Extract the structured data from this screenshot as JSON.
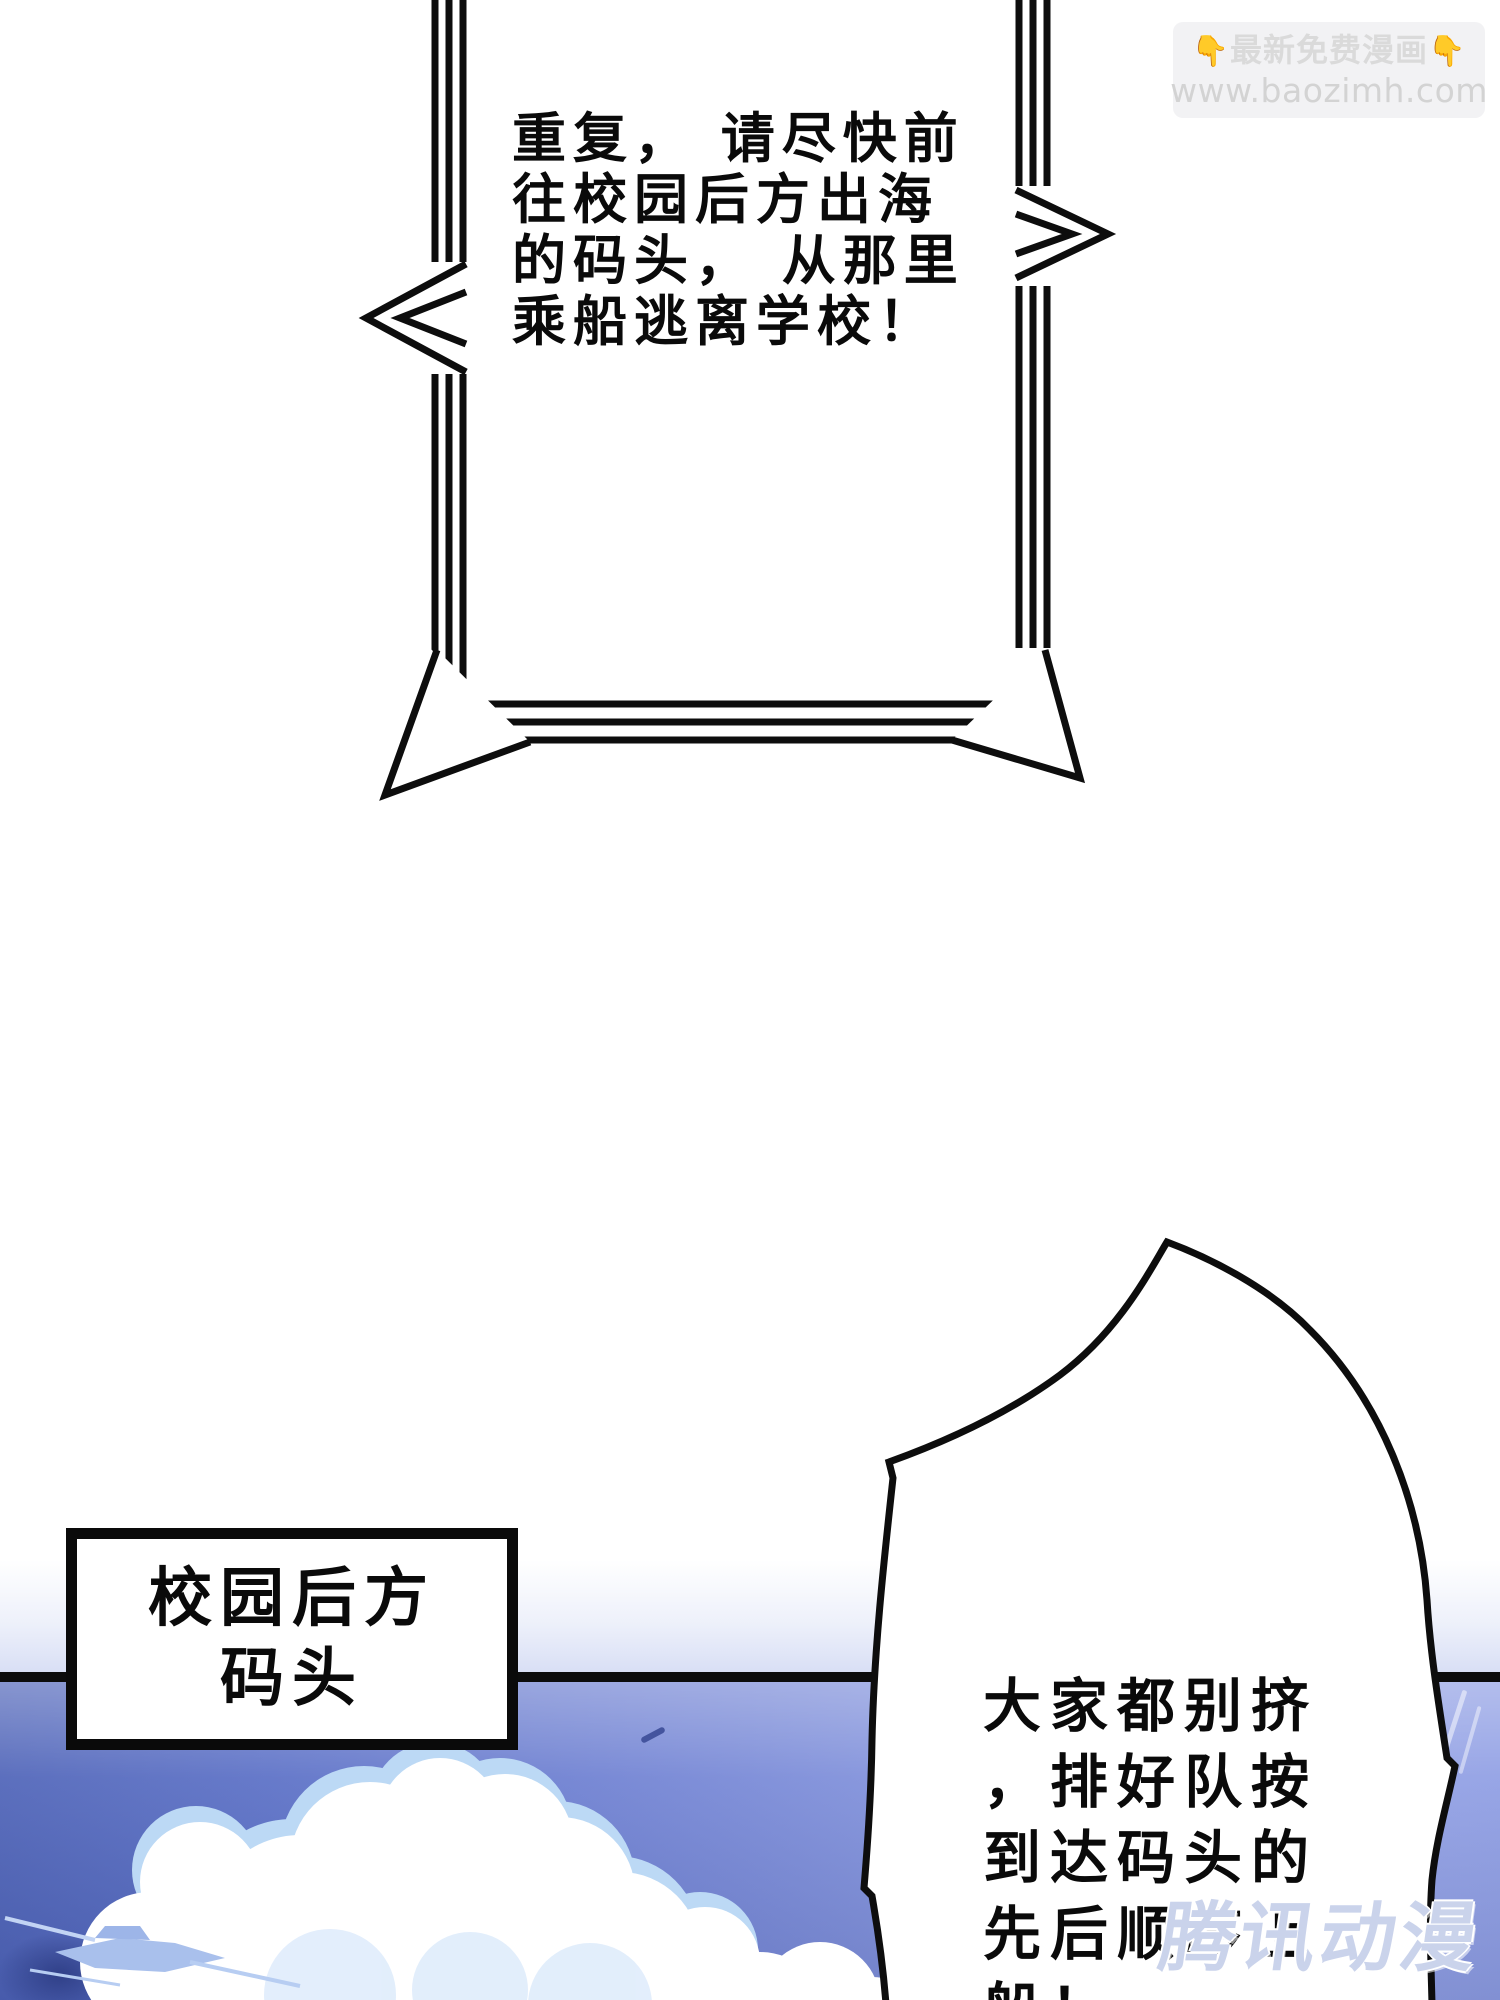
{
  "page": {
    "width": 1500,
    "height": 2000
  },
  "top_watermark": {
    "icon": "👇",
    "promo": "最新免费漫画",
    "url": "www.baozimh.com"
  },
  "broadcast_bubble": {
    "lines": [
      "重复， 请尽快前",
      "往校园后方出海",
      "的码头， 从那里",
      "乘船逃离学校！"
    ]
  },
  "location_label": {
    "lines": [
      "校园后方",
      "码头"
    ]
  },
  "speech_bubble": {
    "lines": [
      "大家都别挤",
      "，排好队按",
      "到达码头的",
      "先后顺序上",
      "船！"
    ]
  },
  "bottom_watermark": {
    "text": "腾讯动漫"
  },
  "colors": {
    "ink": "#0d0d0d",
    "divider": "#0c0c0c",
    "panel_left_blue": "#4e63b8",
    "panel_right_blue": "#93a2e6",
    "cloud_white": "#ffffff",
    "cloud_shadow": "#bcd9f5",
    "boat_blue": "#a9c0ec",
    "promo_gray": "#dadada",
    "tencent_lavender": "#c7d1ea"
  }
}
